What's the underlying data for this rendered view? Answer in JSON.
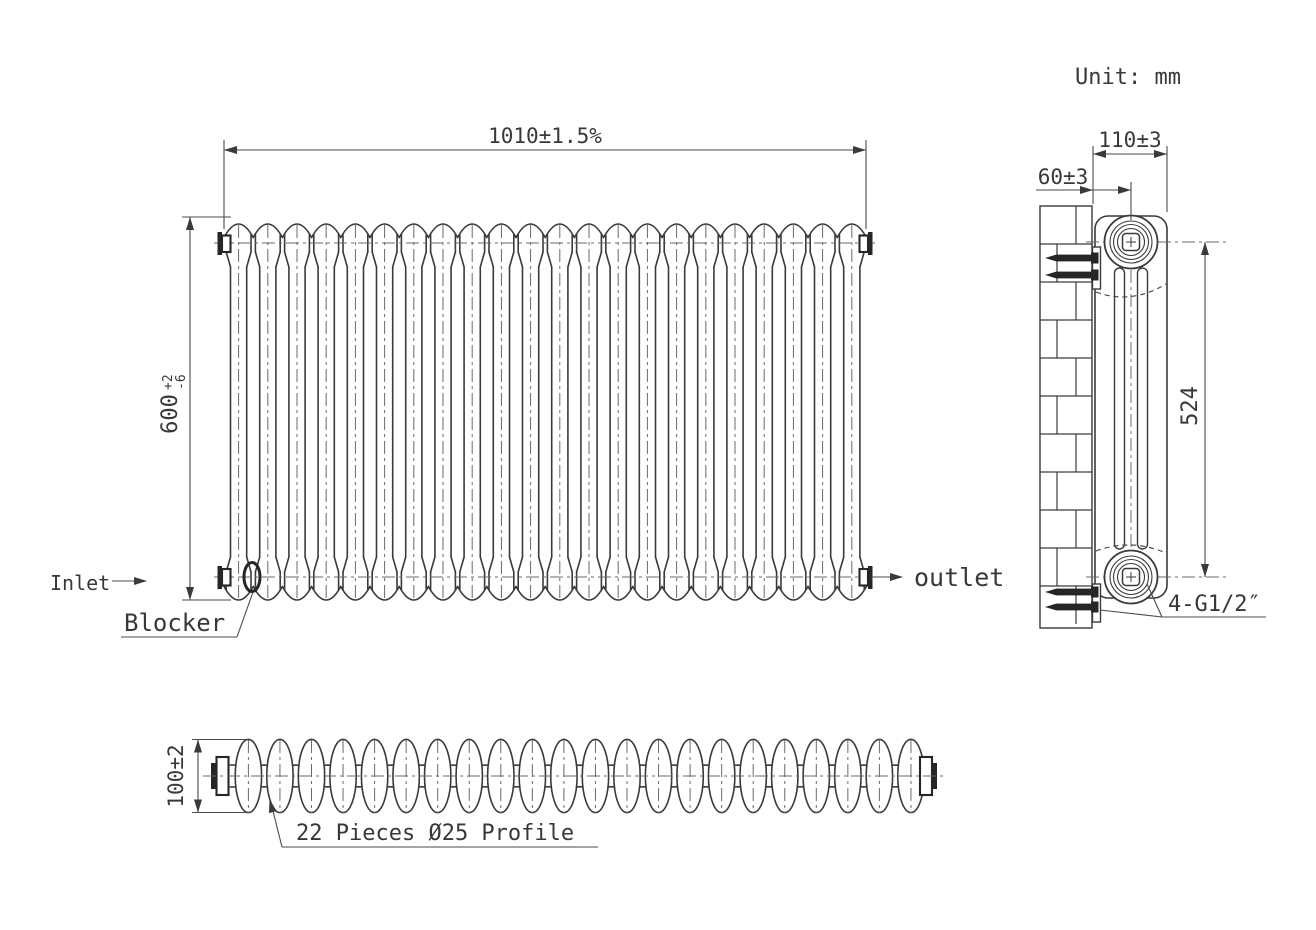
{
  "meta": {
    "unit_label": "Unit: mm",
    "ink_color": "#3a3a3a",
    "background_color": "#ffffff"
  },
  "front_view": {
    "dim_width": "1010±1.5%",
    "dim_height_value": "600",
    "dim_height_tol_upper": "+2",
    "dim_height_tol_lower": "-6",
    "inlet_label": "Inlet",
    "outlet_label": "outlet",
    "blocker_label": "Blocker",
    "column_count": 22
  },
  "side_view": {
    "dim_depth": "110±3",
    "dim_wall_offset": "60±3",
    "dim_port_span": "524",
    "ports_label": "4-G1/2″"
  },
  "bottom_view": {
    "dim_thickness": "100±2",
    "profile_label": "22 Pieces Ø25 Profile",
    "piece_count": 22
  }
}
